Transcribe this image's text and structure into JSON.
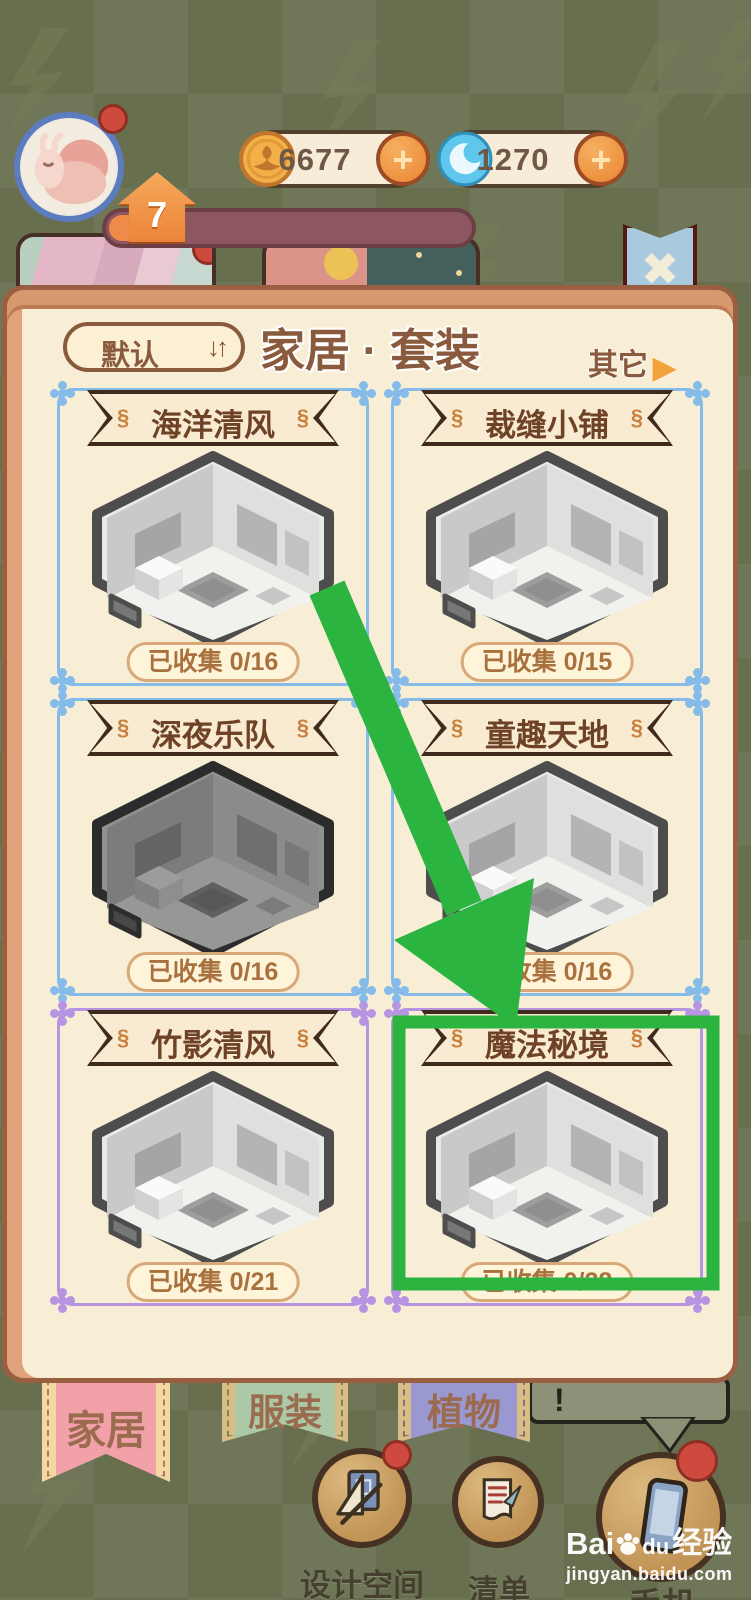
{
  "hud": {
    "level": "7",
    "coins": "6677",
    "gems": "1270",
    "plus_icon": "+"
  },
  "window": {
    "sort_label": "默认",
    "sort_icon": "↓↑",
    "title": "家居 · 套装",
    "more_label": "其它",
    "more_icon": "▶",
    "close_icon": "✖"
  },
  "icons": {
    "banner_ornament": "§"
  },
  "cards": [
    {
      "title": "海洋清风",
      "collected_label": "已收集",
      "collected_value": "0/16"
    },
    {
      "title": "裁缝小铺",
      "collected_label": "已收集",
      "collected_value": "0/15"
    },
    {
      "title": "深夜乐队",
      "collected_label": "已收集",
      "collected_value": "0/16"
    },
    {
      "title": "童趣天地",
      "collected_label": "已收集",
      "collected_value": "0/16"
    },
    {
      "title": "竹影清风",
      "collected_label": "已收集",
      "collected_value": "0/21"
    },
    {
      "title": "魔法秘境",
      "collected_label": "已收集",
      "collected_value": "0/28"
    }
  ],
  "tabs": [
    {
      "label": "家居"
    },
    {
      "label": "服装"
    },
    {
      "label": "植物"
    }
  ],
  "alert_bubble": {
    "text": "!"
  },
  "buttons": [
    {
      "label": "设计空间"
    },
    {
      "label": "清单"
    },
    {
      "label": "手机"
    }
  ],
  "watermark": {
    "brand_prefix": "Bai",
    "brand_suffix": "du",
    "brand_cn": "经验",
    "url": "jingyan.baidu.com"
  },
  "colors": {
    "annotation_green": "#2cb440",
    "frame_blue": "#85bbe8",
    "frame_purple": "#b794e2",
    "panel_cream": "#f8eed6",
    "panel_frame": "#d7996e",
    "bg_olive": "#6a7150",
    "banner_text": "#6e4226",
    "count_text": "#a9713d",
    "tab_home_pink": "#f2a1a8",
    "tab_cloth_green": "#abc9a6",
    "tab_plant_purple": "#9a98d0"
  }
}
